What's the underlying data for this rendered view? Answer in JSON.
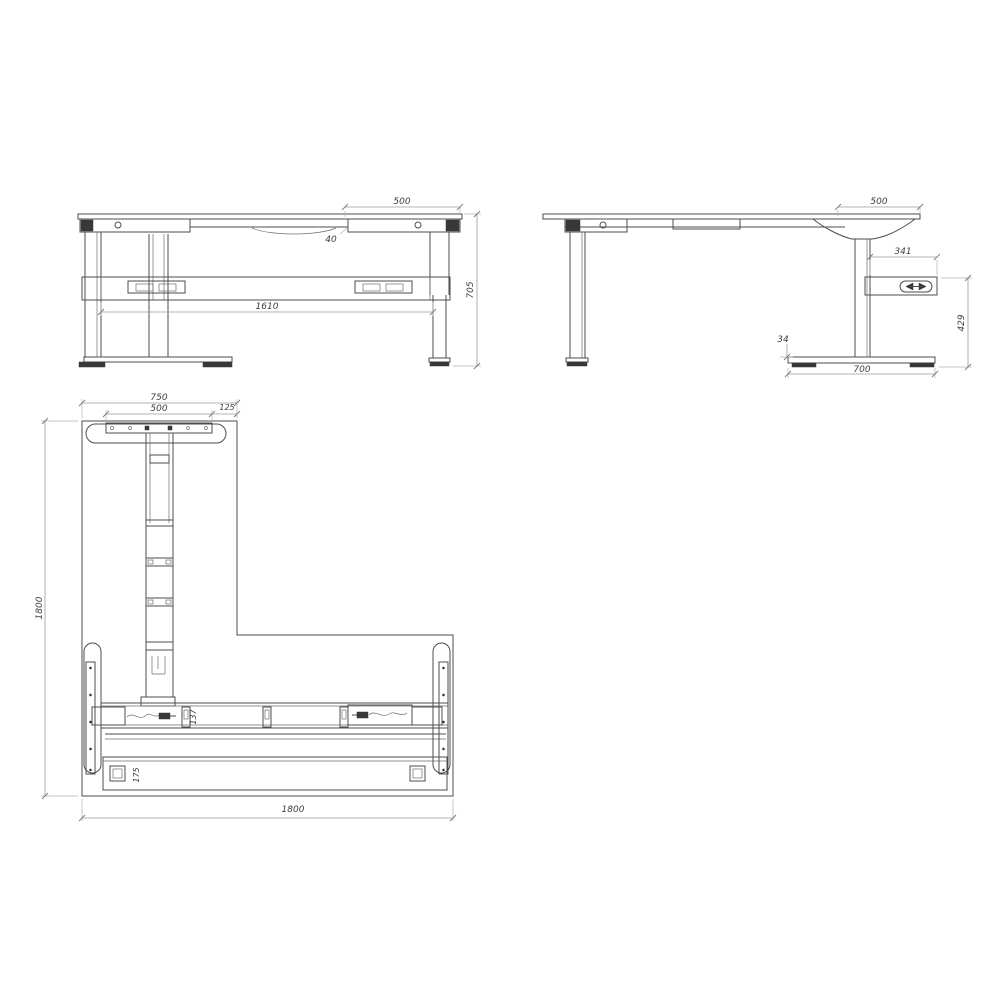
{
  "page": {
    "background": "#ffffff",
    "object_line_color": "#4d4d4d",
    "dimension_line_color": "#9a9a9a",
    "dimension_text_color": "#3d3d3d"
  },
  "drawing": {
    "type": "orthographic technical drawing",
    "subject": "height-adjustable L-shaped desk frame",
    "views": {
      "front": {
        "name": "front elevation",
        "dimensions": {
          "top_overhang": "500",
          "frame_thickness": "40",
          "leg_span": "1610",
          "overall_height": "705"
        }
      },
      "side": {
        "name": "side elevation",
        "dimensions": {
          "top_overhang": "500",
          "control_box_width": "341",
          "underside_height": "429",
          "foot_thickness": "34",
          "foot_depth": "700"
        }
      },
      "plan": {
        "name": "top plan",
        "dimensions": {
          "return_depth": "750",
          "plate_width": "500",
          "edge_offset": "125",
          "return_length": "1800",
          "beam_depth": "137",
          "rail_depth": "175",
          "overall_width": "1800"
        }
      }
    },
    "icons": {
      "controller": "height-adjust-arrows-icon",
      "cables": "power-cable-icon"
    }
  }
}
